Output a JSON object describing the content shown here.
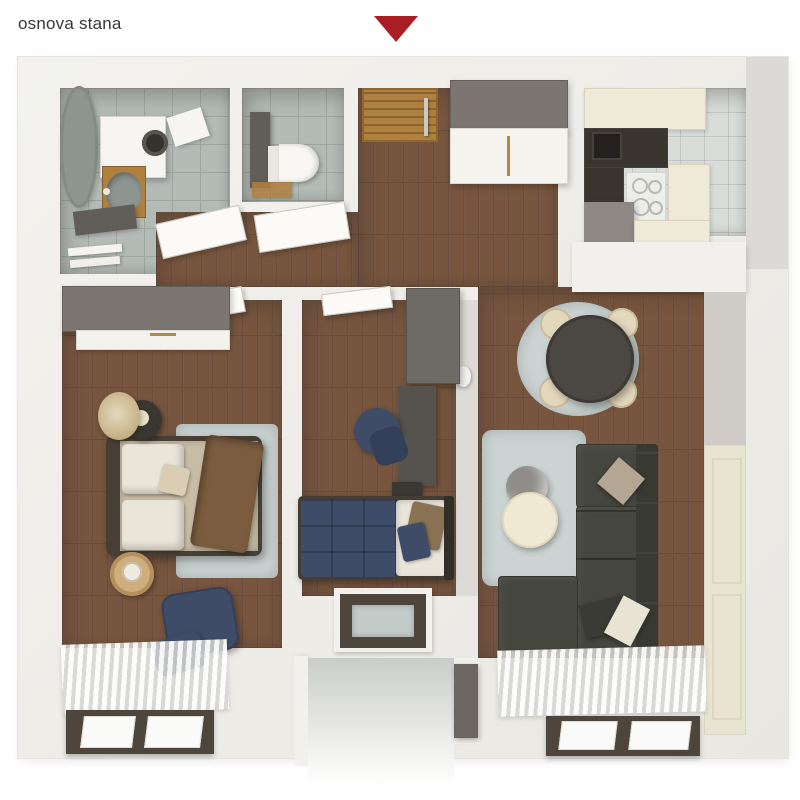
{
  "header": {
    "title": "osnova stana",
    "arrow_icon": "triangle-down-marker"
  },
  "palette": {
    "red": "#A81E22",
    "text": "#383838",
    "wall": "#F1F0EC",
    "wallShade": "#DDDBD6",
    "exterior": "#DCDAD6",
    "wood": "#77553E",
    "woodDark": "#5F4130",
    "tile": "#B4BBB6",
    "tileLine": "#9DA69F",
    "kitchenFloor": "#D9DDDA",
    "cream": "#EFEAD8",
    "creamLine": "#D9D3BD",
    "counter": "#3A352F",
    "sinkBlack": "#23201D",
    "furnGray": "#7B7671",
    "furnGrayDark": "#615D58",
    "deskGray": "#56524D",
    "navy": "#3E4C68",
    "navyDark": "#344059",
    "rug": "#CBD4D2",
    "sofa": "#45463E",
    "sofaDark": "#383931",
    "doorWood": "#B0803F",
    "frameDark": "#4E463C",
    "mattress": "#C8BCA6",
    "pillow": "#EAE5D9",
    "blanket": "#7B5C3E",
    "basin": "#8E9590",
    "panelCream": "#E9E4D1"
  },
  "plan": {
    "rooms": [
      "bathroom",
      "toilet",
      "hallway",
      "kitchen",
      "dining-area",
      "living-room",
      "bedroom",
      "kids-room",
      "loggia"
    ],
    "furniture": [
      "bathtub",
      "washing-machine",
      "vanity-sink",
      "towel-rail",
      "toilet",
      "entry-door",
      "hall-wardrobe",
      "kitchen-cabinets",
      "sink",
      "cooktop",
      "fridge",
      "dining-table",
      "dining-chairs",
      "corner-sofa",
      "coffee-tables",
      "double-bed",
      "single-bed",
      "wardrobe",
      "desk",
      "office-chair",
      "armchair",
      "plant",
      "windows"
    ]
  }
}
